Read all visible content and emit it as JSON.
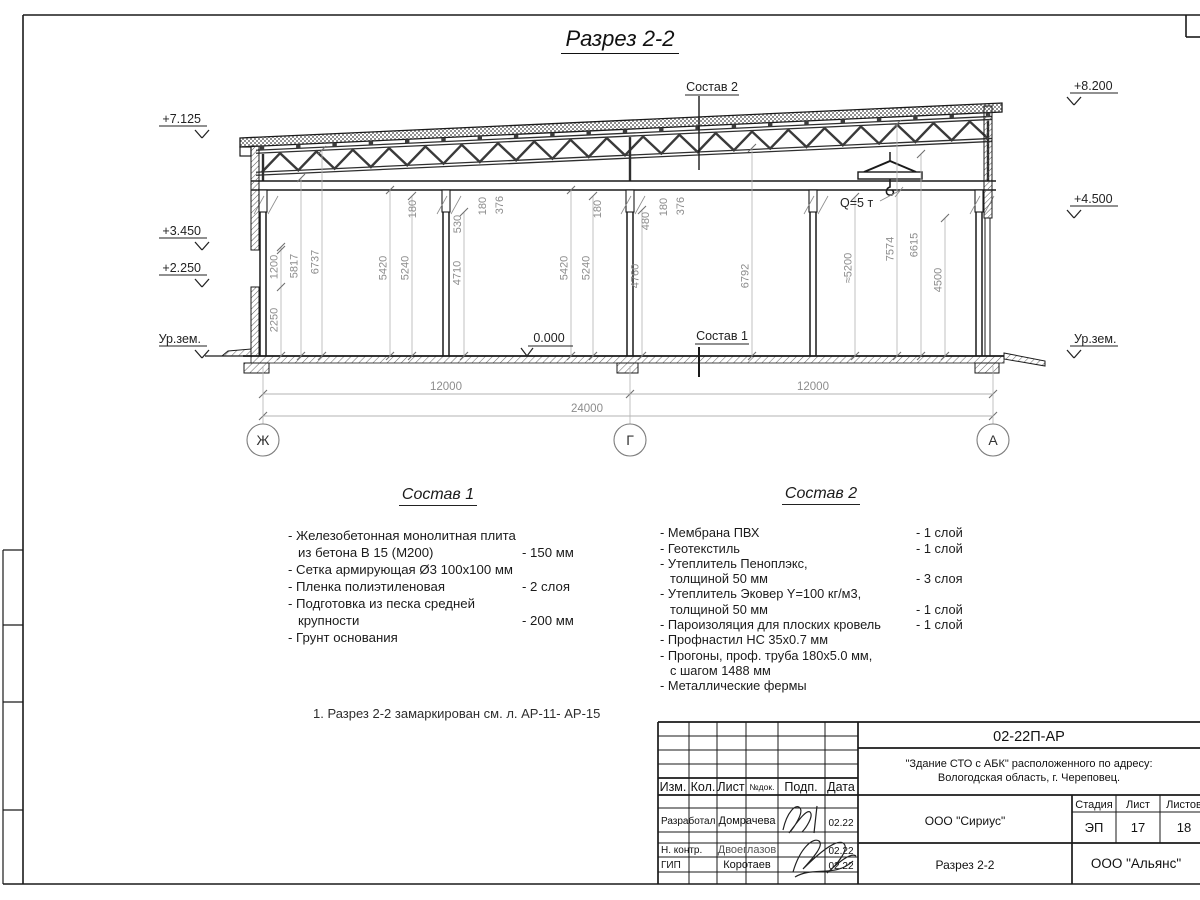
{
  "page": {
    "title": "Разрез 2-2"
  },
  "drawing": {
    "elev_left": [
      "+7.125",
      "+3.450",
      "+2.250",
      "Ур.зем."
    ],
    "elev_right": [
      "+8.200",
      "+4.500",
      "Ур.зем."
    ],
    "vdims": [
      "2250",
      "1200",
      "5817",
      "6737",
      "5420",
      "5240",
      "4710",
      "180",
      "530",
      "180",
      "376",
      "180",
      "5420",
      "5240",
      "480",
      "180",
      "376",
      "4760",
      "6792",
      "≈5200",
      "7574",
      "6615",
      "4500"
    ],
    "hdims": [
      "12000",
      "12000",
      "24000"
    ],
    "axes": [
      "Ж",
      "Г",
      "А"
    ],
    "callouts": {
      "zero": "0.000",
      "sostav1": "Состав 1",
      "sostav2": "Состав 2",
      "crane": "Q=5 т"
    }
  },
  "sostav1": {
    "heading": "Состав 1",
    "rows": [
      {
        "t": "- Железобетонная  монолитная плита"
      },
      {
        "t": "из бетона В 15 (М200)",
        "v": "- 150 мм"
      },
      {
        "t": "- Сетка армирующая Ø3 100х100 мм"
      },
      {
        "t": "- Пленка полиэтиленовая",
        "v": "-  2 слоя"
      },
      {
        "t": "- Подготовка из песка средней"
      },
      {
        "t": "крупности",
        "v": "- 200 мм"
      },
      {
        "t": "- Грунт основания"
      }
    ]
  },
  "sostav2": {
    "heading": "Состав 2",
    "rows": [
      {
        "t": "- Мембрана ПВХ",
        "v": "- 1 слой"
      },
      {
        "t": "- Геотекстиль",
        "v": "- 1 слой"
      },
      {
        "t": "- Утеплитель Пеноплэкс,"
      },
      {
        "t": "толщиной 50 мм",
        "v": "- 3 слоя"
      },
      {
        "t": "- Утеплитель Эковер Y=100 кг/м3,"
      },
      {
        "t": "толщиной 50 мм",
        "v": "- 1 слой"
      },
      {
        "t": "- Пароизоляция для плоских кровель",
        "v": "- 1 слой"
      },
      {
        "t": "- Профнастил НС 35х0.7 мм"
      },
      {
        "t": "- Прогоны, проф. труба 180х5.0 мм,"
      },
      {
        "t": "с шагом 1488 мм"
      },
      {
        "t": "- Металлические фермы"
      }
    ]
  },
  "note": {
    "text": "1. Разрез 2-2 замаркирован см. л. АР-11- АР-15"
  },
  "stamp": {
    "doc_code": "02-22П-АР",
    "object_line1": "\"Здание СТО с АБК\" расположенного по адресу:",
    "object_line2": "Вологодская область, г. Череповец.",
    "cols": {
      "izm": "Изм.",
      "kol": "Кол.",
      "list": "Лист",
      "ndok": "№док.",
      "podp": "Подп.",
      "data": "Дата"
    },
    "rows": [
      {
        "role": "Разработал",
        "name": "Домрачева",
        "date": "02.22"
      },
      {
        "role": "Н. контр.",
        "name": "Двоеглазов",
        "date": "02.22"
      },
      {
        "role": "ГИП",
        "name": "Коротаев",
        "date": "02.22"
      }
    ],
    "org_design": "ООО \"Сириус\"",
    "sheet_title": "Разрез 2-2",
    "org_customer": "ООО \"Альянс\"",
    "stage_label": "Стадия",
    "sheet_label": "Лист",
    "sheets_label": "Листов",
    "stage": "ЭП",
    "sheet_no": "17",
    "sheets_total": "18"
  }
}
